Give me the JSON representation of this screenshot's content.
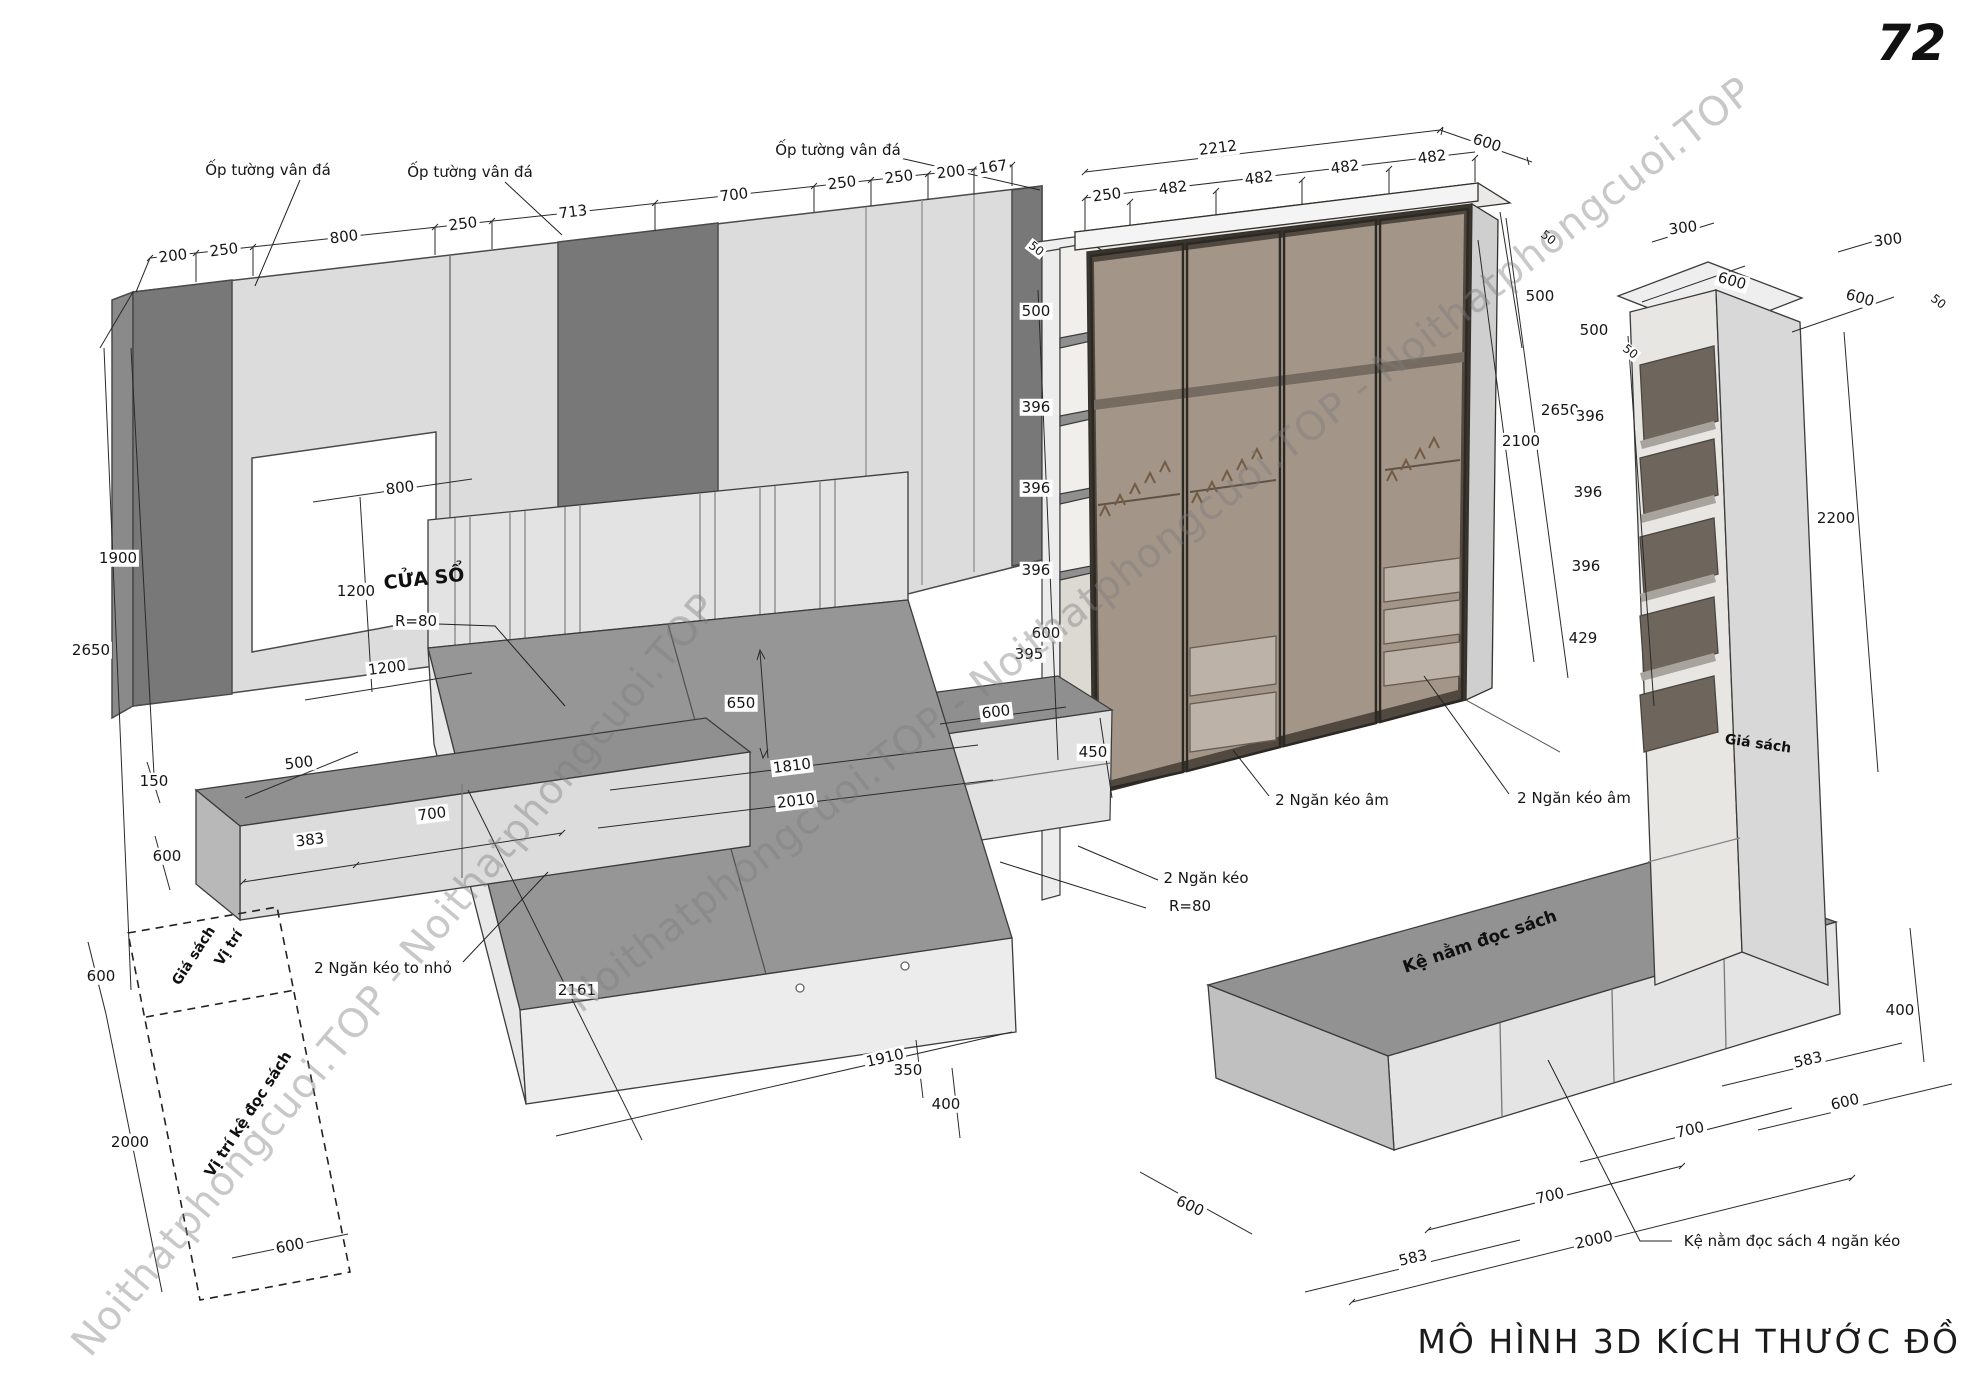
{
  "page": {
    "number": "72",
    "title": "MÔ HÌNH 3D KÍCH THƯỚC ĐỒ"
  },
  "watermark_text": "Noithatphongcuoi.TOP",
  "colors": {
    "stone_panel": "#787878",
    "wall_light": "#dcdcdc",
    "line": "#222222",
    "furniture_top": "#929292",
    "furniture_face": "#e4e4e4",
    "wardrobe_glass": "rgba(130,115,102,0.32)",
    "wardrobe_interior": "#b3a698",
    "watermark": "rgba(125,125,125,0.42)"
  },
  "annotations": [
    {
      "n": "dim-label",
      "t": "200",
      "x": 173,
      "y": 256,
      "r": -7,
      "cls": "d"
    },
    {
      "n": "dim-label",
      "t": "250",
      "x": 224,
      "y": 250,
      "r": -7,
      "cls": "d"
    },
    {
      "n": "dim-label",
      "t": "800",
      "x": 344,
      "y": 237,
      "r": -7,
      "cls": "d"
    },
    {
      "n": "dim-label",
      "t": "250",
      "x": 463,
      "y": 224,
      "r": -7,
      "cls": "d"
    },
    {
      "n": "dim-label",
      "t": "713",
      "x": 573,
      "y": 212,
      "r": -7,
      "cls": "d"
    },
    {
      "n": "dim-label",
      "t": "700",
      "x": 734,
      "y": 195,
      "r": -7,
      "cls": "d"
    },
    {
      "n": "dim-label",
      "t": "250",
      "x": 842,
      "y": 183,
      "r": -7,
      "cls": "d"
    },
    {
      "n": "dim-label",
      "t": "250",
      "x": 899,
      "y": 177,
      "r": -7,
      "cls": "d"
    },
    {
      "n": "dim-label",
      "t": "200",
      "x": 951,
      "y": 172,
      "r": -7,
      "cls": "d"
    },
    {
      "n": "dim-label",
      "t": "167",
      "x": 993,
      "y": 167,
      "r": -7,
      "cls": "d"
    },
    {
      "n": "dim-label",
      "t": "2212",
      "x": 1218,
      "y": 148,
      "r": -7,
      "cls": "d"
    },
    {
      "n": "dim-label",
      "t": "600",
      "x": 1487,
      "y": 143,
      "r": 18,
      "cls": "d"
    },
    {
      "n": "dim-label",
      "t": "250",
      "x": 1107,
      "y": 195,
      "r": -7,
      "cls": "d"
    },
    {
      "n": "dim-label",
      "t": "482",
      "x": 1173,
      "y": 188,
      "r": -7,
      "cls": "d"
    },
    {
      "n": "dim-label",
      "t": "482",
      "x": 1259,
      "y": 178,
      "r": -7,
      "cls": "d"
    },
    {
      "n": "dim-label",
      "t": "482",
      "x": 1345,
      "y": 167,
      "r": -7,
      "cls": "d"
    },
    {
      "n": "dim-label",
      "t": "482",
      "x": 1432,
      "y": 157,
      "r": -7,
      "cls": "d"
    },
    {
      "n": "dim-label",
      "t": "1900",
      "x": 118,
      "y": 558,
      "r": 0,
      "cls": "d"
    },
    {
      "n": "dim-label",
      "t": "2650",
      "x": 91,
      "y": 650,
      "r": 0,
      "cls": "d"
    },
    {
      "n": "dim-label",
      "t": "800",
      "x": 400,
      "y": 488,
      "r": -7,
      "cls": "d"
    },
    {
      "n": "dim-label",
      "t": "1200",
      "x": 356,
      "y": 591,
      "r": 0,
      "cls": "d"
    },
    {
      "n": "dim-label",
      "t": "1200",
      "x": 387,
      "y": 668,
      "r": -7,
      "cls": "d"
    },
    {
      "n": "dim-label",
      "t": "R=80",
      "x": 416,
      "y": 621,
      "r": 0,
      "cls": "d"
    },
    {
      "n": "dim-label",
      "t": "150",
      "x": 154,
      "y": 781,
      "r": 0,
      "cls": "d"
    },
    {
      "n": "dim-label",
      "t": "500",
      "x": 299,
      "y": 763,
      "r": -7,
      "cls": "d"
    },
    {
      "n": "dim-label",
      "t": "700",
      "x": 432,
      "y": 814,
      "r": -7,
      "cls": "d"
    },
    {
      "n": "dim-label",
      "t": "383",
      "x": 310,
      "y": 840,
      "r": -7,
      "cls": "d"
    },
    {
      "n": "dim-label",
      "t": "600",
      "x": 167,
      "y": 856,
      "r": 0,
      "cls": "d"
    },
    {
      "n": "dim-label",
      "t": "650",
      "x": 741,
      "y": 703,
      "r": 0,
      "cls": "d"
    },
    {
      "n": "dim-label",
      "t": "1810",
      "x": 792,
      "y": 766,
      "r": -7,
      "cls": "d"
    },
    {
      "n": "dim-label",
      "t": "2010",
      "x": 796,
      "y": 801,
      "r": -7,
      "cls": "d"
    },
    {
      "n": "dim-label",
      "t": "2161",
      "x": 577,
      "y": 990,
      "r": 0,
      "cls": "d"
    },
    {
      "n": "dim-label",
      "t": "1910",
      "x": 885,
      "y": 1058,
      "r": -13,
      "cls": "d"
    },
    {
      "n": "dim-label",
      "t": "350",
      "x": 908,
      "y": 1070,
      "r": 0,
      "cls": "d"
    },
    {
      "n": "dim-label",
      "t": "400",
      "x": 946,
      "y": 1104,
      "r": 0,
      "cls": "d"
    },
    {
      "n": "dim-label",
      "t": "600",
      "x": 996,
      "y": 712,
      "r": -7,
      "cls": "d"
    },
    {
      "n": "dim-label",
      "t": "450",
      "x": 1093,
      "y": 752,
      "r": 0,
      "cls": "d"
    },
    {
      "n": "dim-label",
      "t": "50",
      "x": 1036,
      "y": 249,
      "r": 38,
      "cls": "d",
      "fs": 12
    },
    {
      "n": "dim-label",
      "t": "500",
      "x": 1036,
      "y": 311,
      "r": 0,
      "cls": "d"
    },
    {
      "n": "dim-label",
      "t": "396",
      "x": 1036,
      "y": 407,
      "r": 0,
      "cls": "d"
    },
    {
      "n": "dim-label",
      "t": "396",
      "x": 1036,
      "y": 488,
      "r": 0,
      "cls": "d"
    },
    {
      "n": "dim-label",
      "t": "396",
      "x": 1036,
      "y": 570,
      "r": 0,
      "cls": "d"
    },
    {
      "n": "dim-label",
      "t": "600",
      "x": 1046,
      "y": 633,
      "r": 0,
      "cls": "d"
    },
    {
      "n": "dim-label",
      "t": "395",
      "x": 1029,
      "y": 654,
      "r": 0,
      "cls": "d"
    },
    {
      "n": "dim-label",
      "t": "50",
      "x": 1548,
      "y": 238,
      "r": 38,
      "cls": "d",
      "fs": 12
    },
    {
      "n": "dim-label",
      "t": "500",
      "x": 1540,
      "y": 296,
      "r": 0,
      "cls": "d"
    },
    {
      "n": "dim-label",
      "t": "2650",
      "x": 1560,
      "y": 410,
      "r": 0,
      "cls": "d"
    },
    {
      "n": "dim-label",
      "t": "2100",
      "x": 1521,
      "y": 441,
      "r": 0,
      "cls": "d"
    },
    {
      "n": "dim-label",
      "t": "300",
      "x": 1683,
      "y": 228,
      "r": -7,
      "cls": "d"
    },
    {
      "n": "dim-label",
      "t": "600",
      "x": 1732,
      "y": 281,
      "r": 16,
      "cls": "d"
    },
    {
      "n": "dim-label",
      "t": "300",
      "x": 1888,
      "y": 240,
      "r": -7,
      "cls": "d"
    },
    {
      "n": "dim-label",
      "t": "600",
      "x": 1860,
      "y": 298,
      "r": 16,
      "cls": "d"
    },
    {
      "n": "dim-label",
      "t": "50",
      "x": 1630,
      "y": 352,
      "r": 38,
      "cls": "d",
      "fs": 12
    },
    {
      "n": "dim-label",
      "t": "50",
      "x": 1938,
      "y": 302,
      "r": 38,
      "cls": "d",
      "fs": 12
    },
    {
      "n": "dim-label",
      "t": "500",
      "x": 1594,
      "y": 330,
      "r": 0,
      "cls": "d"
    },
    {
      "n": "dim-label",
      "t": "396",
      "x": 1590,
      "y": 416,
      "r": 0,
      "cls": "d"
    },
    {
      "n": "dim-label",
      "t": "396",
      "x": 1588,
      "y": 492,
      "r": 0,
      "cls": "d"
    },
    {
      "n": "dim-label",
      "t": "396",
      "x": 1586,
      "y": 566,
      "r": 0,
      "cls": "d"
    },
    {
      "n": "dim-label",
      "t": "429",
      "x": 1583,
      "y": 638,
      "r": 0,
      "cls": "d"
    },
    {
      "n": "dim-label",
      "t": "2200",
      "x": 1836,
      "y": 518,
      "r": 0,
      "cls": "d"
    },
    {
      "n": "dim-label",
      "t": "400",
      "x": 1900,
      "y": 1010,
      "r": 0,
      "cls": "d"
    },
    {
      "n": "dim-label",
      "t": "583",
      "x": 1808,
      "y": 1060,
      "r": -13,
      "cls": "d"
    },
    {
      "n": "dim-label",
      "t": "600",
      "x": 1845,
      "y": 1102,
      "r": -13,
      "cls": "d"
    },
    {
      "n": "dim-label",
      "t": "700",
      "x": 1690,
      "y": 1130,
      "r": -13,
      "cls": "d"
    },
    {
      "n": "dim-label",
      "t": "700",
      "x": 1550,
      "y": 1196,
      "r": -13,
      "cls": "d"
    },
    {
      "n": "dim-label",
      "t": "2000",
      "x": 1594,
      "y": 1240,
      "r": -13,
      "cls": "d"
    },
    {
      "n": "dim-label",
      "t": "583",
      "x": 1413,
      "y": 1258,
      "r": -13,
      "cls": "d"
    },
    {
      "n": "dim-label",
      "t": "600",
      "x": 1190,
      "y": 1206,
      "r": 25,
      "cls": "d"
    },
    {
      "n": "dim-label",
      "t": "600",
      "x": 101,
      "y": 976,
      "r": 0,
      "cls": "d"
    },
    {
      "n": "dim-label",
      "t": "2000",
      "x": 130,
      "y": 1142,
      "r": 0,
      "cls": "d"
    },
    {
      "n": "dim-label",
      "t": "600",
      "x": 290,
      "y": 1246,
      "r": -11,
      "cls": "d"
    },
    {
      "n": "dim-label",
      "t": "R=80",
      "x": 1190,
      "y": 906,
      "r": 0,
      "cls": "d"
    },
    {
      "n": "callout-wall-cladding",
      "t": "Ốp tường vân đá",
      "x": 268,
      "y": 170,
      "r": 0,
      "cls": "c"
    },
    {
      "n": "callout-wall-cladding",
      "t": "Ốp tường vân đá",
      "x": 470,
      "y": 172,
      "r": 0,
      "cls": "c"
    },
    {
      "n": "callout-wall-cladding",
      "t": "Ốp tường vân đá",
      "x": 838,
      "y": 150,
      "r": 0,
      "cls": "c"
    },
    {
      "n": "callout-drawers-big-small",
      "t": "2 Ngăn kéo to nhỏ",
      "x": 383,
      "y": 968,
      "r": 0,
      "cls": "c"
    },
    {
      "n": "callout-drawers",
      "t": "2 Ngăn kéo",
      "x": 1206,
      "y": 878,
      "r": 0,
      "cls": "c"
    },
    {
      "n": "callout-hidden-drawers",
      "t": "2 Ngăn kéo âm",
      "x": 1332,
      "y": 800,
      "r": 0,
      "cls": "c"
    },
    {
      "n": "callout-hidden-drawers",
      "t": "2 Ngăn kéo âm",
      "x": 1574,
      "y": 798,
      "r": 0,
      "cls": "c"
    },
    {
      "n": "callout-reading-shelf-drawers",
      "t": "Kệ nằm đọc sách 4 ngăn kéo",
      "x": 1792,
      "y": 1241,
      "r": 0,
      "cls": "c"
    },
    {
      "n": "label-window",
      "t": "CỬA SỔ",
      "x": 424,
      "y": 579,
      "r": -6,
      "cls": "f",
      "fs": 19
    },
    {
      "n": "label-reading-bench",
      "t": "Kệ nằm đọc sách",
      "x": 1480,
      "y": 942,
      "r": -19,
      "cls": "f",
      "fs": 17
    },
    {
      "n": "label-bookshelf",
      "t": "Giá sách",
      "x": 1758,
      "y": 744,
      "r": 8,
      "cls": "f",
      "fs": 14
    },
    {
      "n": "label-position",
      "t": "Vị trí",
      "x": 229,
      "y": 948,
      "r": -57,
      "cls": "f",
      "fs": 14
    },
    {
      "n": "label-position-bookshelf",
      "t": "Giá sách",
      "x": 194,
      "y": 956,
      "r": -57,
      "cls": "f",
      "fs": 14
    },
    {
      "n": "label-position-reading-shelf",
      "t": "Vị trí kệ đọc sách",
      "x": 248,
      "y": 1114,
      "r": -57,
      "cls": "f",
      "fs": 15
    },
    {
      "n": "watermark-text",
      "t": "Noithatphongcuoi.TOP - Noithatphongcuoi.TOP - Noithatphongcuoi.TOP",
      "x": 1160,
      "y": 545,
      "r": -38,
      "cls": "w"
    },
    {
      "n": "watermark-text",
      "t": "Noithatphongcuoi.TOP - Noithatphongcuoi.TOP",
      "x": 395,
      "y": 975,
      "r": -50,
      "cls": "w"
    }
  ]
}
